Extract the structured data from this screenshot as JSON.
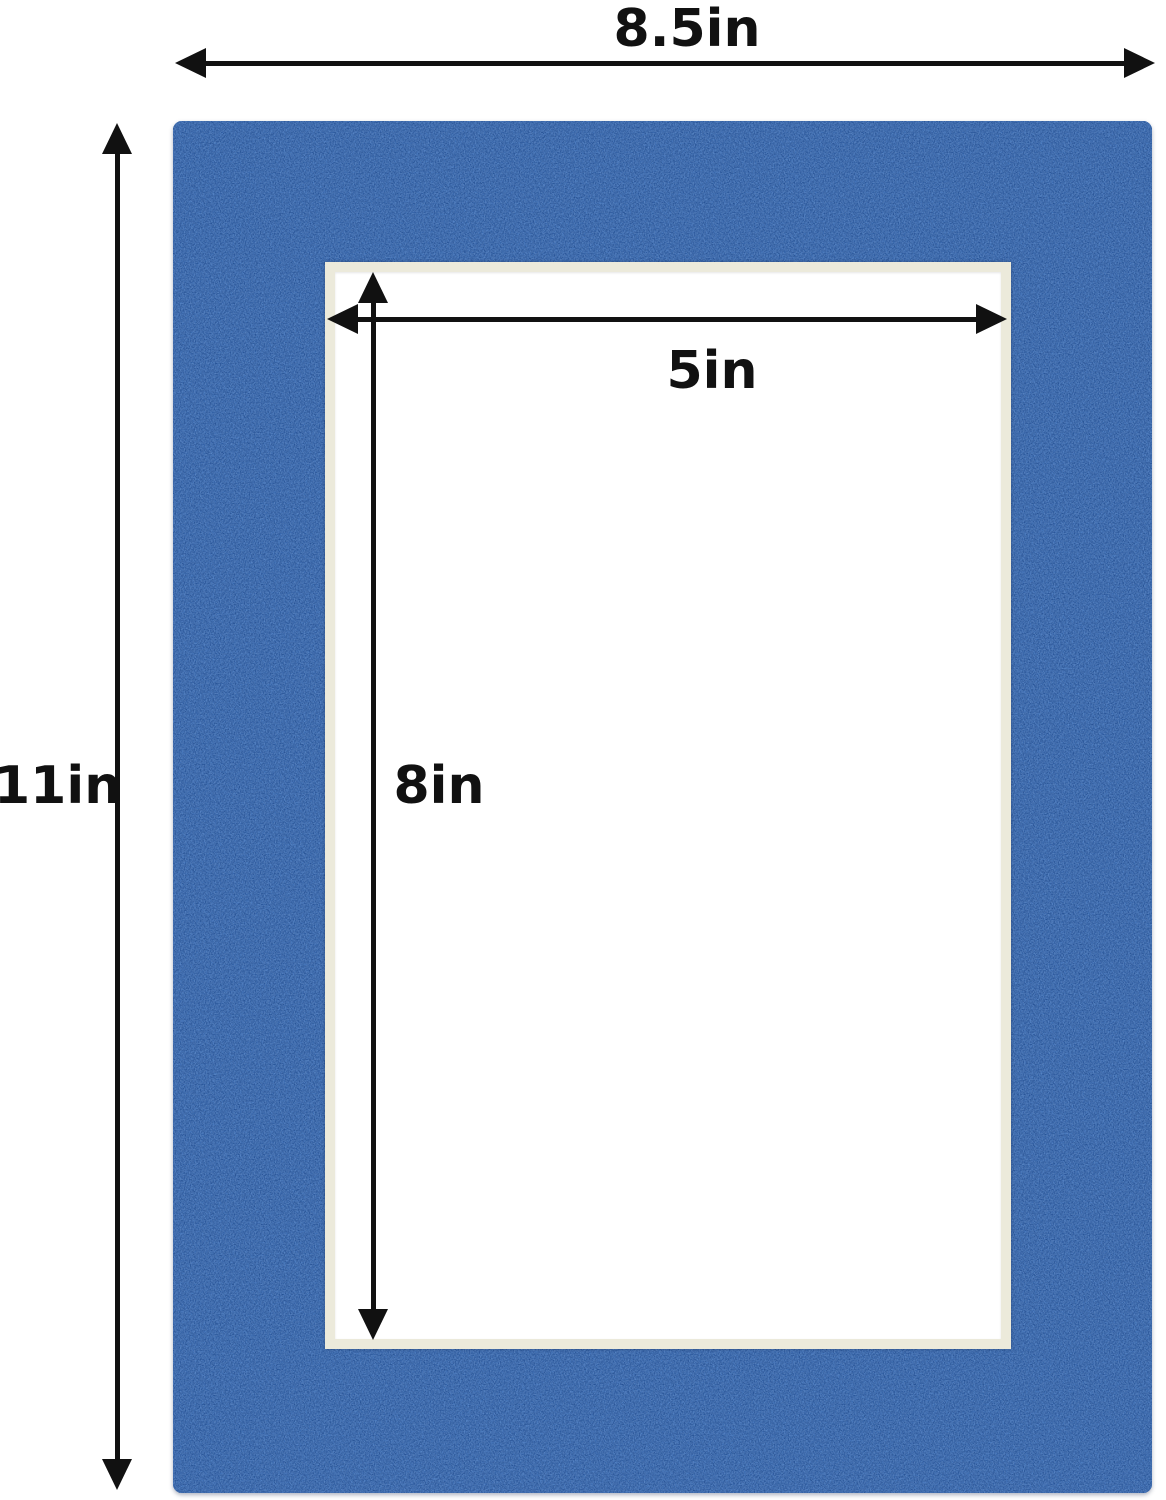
{
  "diagram": {
    "subject": "photo-mat-board-with-opening",
    "outer_width": {
      "label": "8.5in"
    },
    "outer_height": {
      "label": "11in"
    },
    "opening_width": {
      "label": "5in"
    },
    "opening_height": {
      "label": "8in"
    }
  },
  "colors": {
    "mat_blue": "#3a6cb4",
    "mat_texture_dark": "#1d4585",
    "mat_texture_light": "#6f9bd6",
    "bevel_cream": "#eceadb",
    "opening_white": "#ffffff",
    "arrow_black": "#111111",
    "background": "#ffffff"
  }
}
